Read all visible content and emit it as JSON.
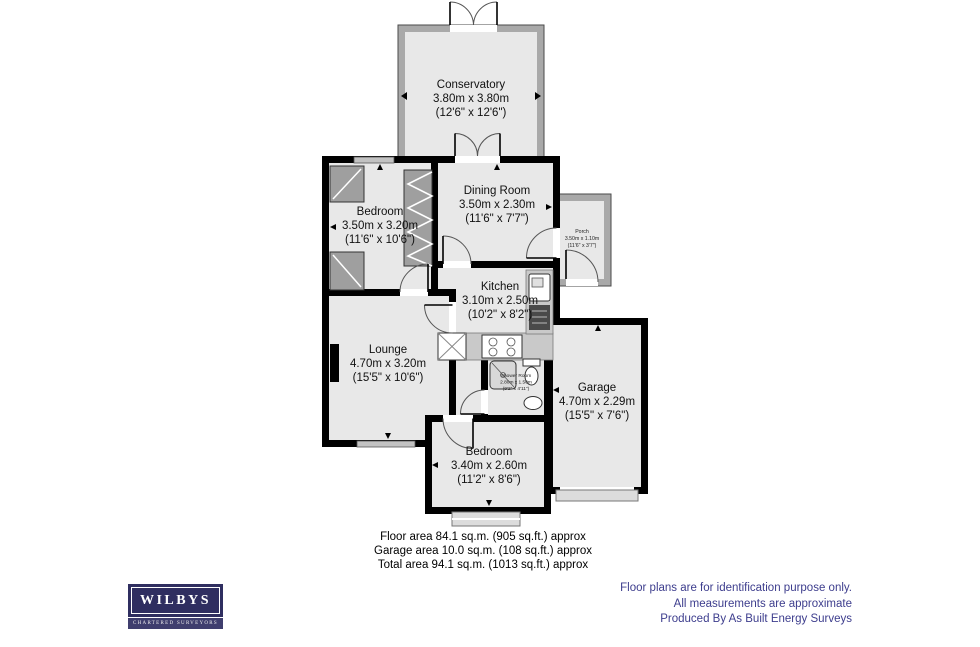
{
  "rooms": {
    "conservatory": {
      "name": "Conservatory",
      "metric": "3.80m x 3.80m",
      "imperial": "(12'6\" x 12'6\")"
    },
    "bedroom1": {
      "name": "Bedroom",
      "metric": "3.50m x 3.20m",
      "imperial": "(11'6\" x 10'6\")"
    },
    "dining": {
      "name": "Dining Room",
      "metric": "3.50m x 2.30m",
      "imperial": "(11'6\" x 7'7\")"
    },
    "porch": {
      "name": "Porch",
      "metric": "3.50m x 1.10m",
      "imperial": "(11'6\" x 3'7\")"
    },
    "kitchen": {
      "name": "Kitchen",
      "metric": "3.10m x 2.50m",
      "imperial": "(10'2\" x 8'2\")"
    },
    "lounge": {
      "name": "Lounge",
      "metric": "4.70m x 3.20m",
      "imperial": "(15'5\" x 10'6\")"
    },
    "shower": {
      "name": "Shower Room",
      "metric": "2.80m x 1.50m",
      "imperial": "(9'2\" x 4'11\")"
    },
    "garage": {
      "name": "Garage",
      "metric": "4.70m x 2.29m",
      "imperial": "(15'5\" x 7'6\")"
    },
    "bedroom2": {
      "name": "Bedroom",
      "metric": "3.40m x 2.60m",
      "imperial": "(11'2\" x 8'6\")"
    }
  },
  "areas": {
    "floor": "Floor area 84.1 sq.m. (905 sq.ft.) approx",
    "garage": "Garage area 10.0 sq.m. (108 sq.ft.) approx",
    "total": "Total area 94.1 sq.m. (1013 sq.ft.) approx"
  },
  "disclaimer": {
    "line1": "Floor plans are for identification purpose only.",
    "line2": "All measurements are approximate",
    "line3": "Produced By As Built Energy Surveys"
  },
  "logo": {
    "name": "WILBYS",
    "tagline": "CHARTERED SURVEYORS"
  },
  "colors": {
    "wall": "#000000",
    "glazed_wall": "#a9a9a9",
    "room_fill": "#e8e8e8",
    "fixture": "#c9c9c9",
    "logo_navy": "#2f2e60",
    "disclaimer_blue": "#3d3d8d"
  }
}
